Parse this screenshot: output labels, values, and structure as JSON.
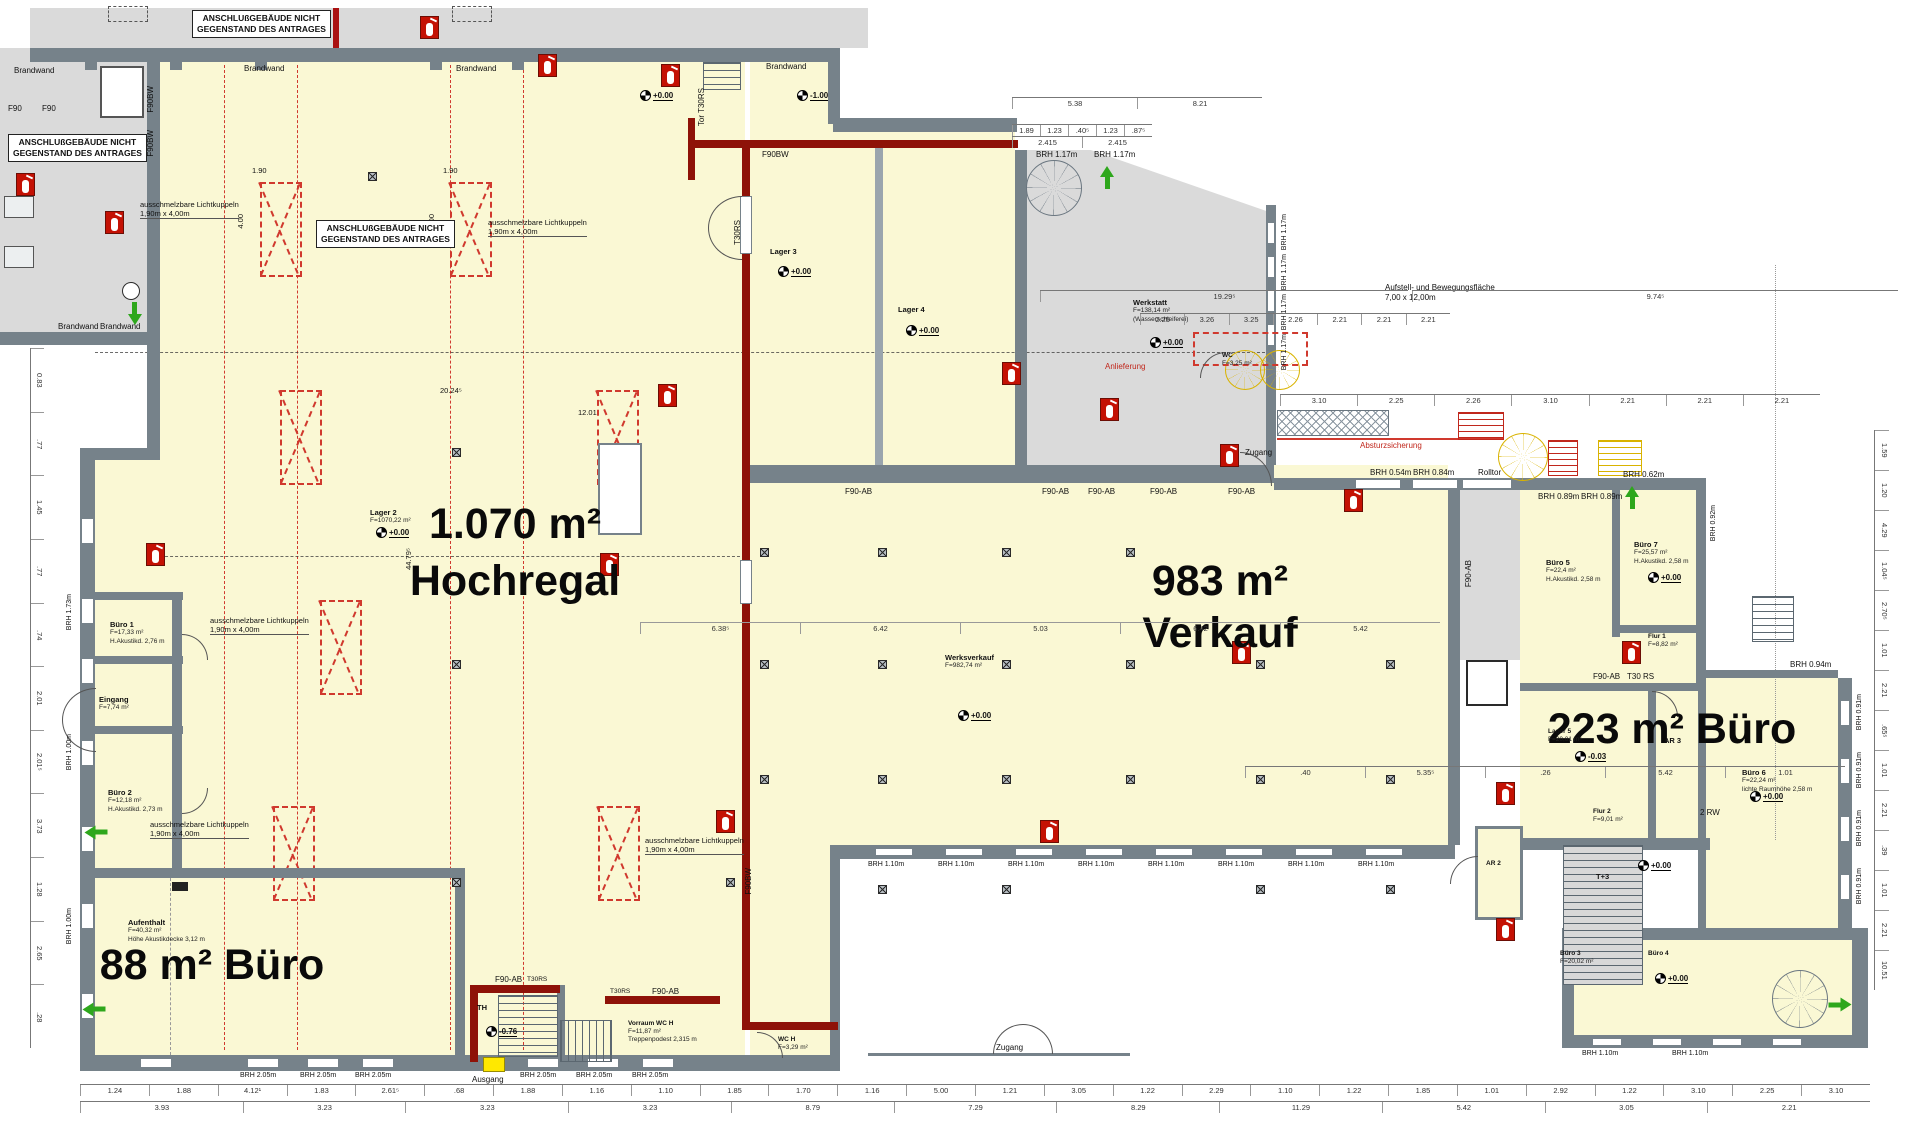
{
  "colors": {
    "floor": "#faf8d4",
    "wall": "#76828a",
    "annex": "#dadada",
    "fire_wall": "#8e1208",
    "dome_red": "#d0392e",
    "escape_green": "#2ea71c",
    "extinguisher_red": "#c41104",
    "highlight_yellow": "#ffe800"
  },
  "icons": {
    "fire_extinguisher": "red square with white extinguisher pictogram",
    "escape_arrow": "green arrow",
    "column": "crossed square",
    "elevation_marker": "quartered circle",
    "light_dome": "red dashed rectangle with X",
    "stairs": "striped run",
    "spiral_stairs": "radial circle",
    "elevator": "crossed white box"
  },
  "titles": {
    "hochregal_size": "1.070 m²",
    "hochregal_name": "Hochregal",
    "verkauf_size": "983 m²",
    "verkauf_name": "Verkauf",
    "buero223": "223 m² Büro",
    "buero88": "88 m² Büro"
  },
  "annex_note": {
    "line1": "ANSCHLUßGEBÄUDE NICHT",
    "line2": "GEGENSTAND DES ANTRAGES"
  },
  "labels": {
    "brandwand": "Brandwand",
    "f90": "F90",
    "f90bw": "F90BW",
    "f90ab": "F90-AB",
    "t30rs": "T30RS",
    "tor_t30rs": "Tor T30RS",
    "t30_rs": "T30 RS",
    "zugang": "Zugang",
    "ausgang": "Ausgang",
    "rolltor": "Rolltor",
    "absturzsicherung": "Absturzsicherung",
    "anlieferung": "Anlieferung",
    "rw2": "2 RW",
    "kuppel1": "ausschmelzbare Lichtkuppeln",
    "kuppel2": "1,90m x 4,00m",
    "aufstell1": "Aufstell- und Bewegungsfläche",
    "aufstell2": "7,00 x 12,00m"
  },
  "win": {
    "brh117": "BRH 1.17m",
    "brh054": "BRH 0.54m",
    "brh084": "BRH 0.84m",
    "brh089": "BRH 0.89m",
    "brh062": "BRH 0.62m",
    "brh092": "BRH 0.92m",
    "brh094": "BRH 0.94m",
    "brh091": "BRH 0.91m",
    "brh205": "BRH 2.05m",
    "brh110": "BRH 1.10m",
    "brh173": "BRH 1.73m",
    "brh100": "BRH 1.00m"
  },
  "markers": {
    "p000": "+0.00",
    "m100": "-1.00"
  },
  "rooms": {
    "lager2": {
      "name": "Lager 2",
      "info": "F=1070,22 m²",
      "elev": "+0.00"
    },
    "lager3": {
      "name": "Lager 3",
      "elev": "+0.00"
    },
    "lager4": {
      "name": "Lager 4",
      "elev": "+0.00"
    },
    "lager5": {
      "name": "Lager 5",
      "info": "F=20,01 m²",
      "elev": "-0.03"
    },
    "werkstatt": {
      "name": "Werkstatt",
      "info": "F=138,14 m²",
      "info2": "(Wasserschleiferei)",
      "elev": "+0.00"
    },
    "werksverkauf": {
      "name": "Werksverkauf",
      "info": "F=982,74 m²",
      "elev": "+0.00"
    },
    "buero1": {
      "name": "Büro 1",
      "info": "F=17,33 m²",
      "info2": "H.Akustikd. 2,76 m"
    },
    "buero2": {
      "name": "Büro 2",
      "info": "F=12,18 m²",
      "info2": "H.Akustikd. 2,73 m"
    },
    "eingang": {
      "name": "Eingang",
      "info": "F=7,74 m²"
    },
    "aufenthalt": {
      "name": "Aufenthalt",
      "info": "F=40,32 m²",
      "info2": "Höhe Akustikdecke 3,12 m"
    },
    "th": {
      "name": "TH",
      "elev": "-0.76"
    },
    "vorraum": {
      "name": "Vorraum WC H",
      "info": "F=11,87 m²",
      "info2": "Treppenpodest 2,315 m"
    },
    "wch": {
      "name": "WC H",
      "info": "F=3,29 m²"
    },
    "wc": {
      "name": "WC",
      "info": "F=3,25 m²"
    },
    "buero5": {
      "name": "Büro 5",
      "info": "F=22,4 m²",
      "info2": "H.Akustikd. 2,58 m"
    },
    "buero7": {
      "name": "Büro 7",
      "info": "F=25,57 m²",
      "info2": "H.Akustikd. 2,58 m",
      "elev": "+0.00"
    },
    "flur1": {
      "name": "Flur 1",
      "info": "F=8,82 m²"
    },
    "flur2": {
      "name": "Flur 2",
      "info": "F=9,01 m²"
    },
    "ar2": {
      "name": "AR 2"
    },
    "ar3": {
      "name": "AR 3"
    },
    "buero6": {
      "name": "Büro 6",
      "info": "F=22,24 m²",
      "info2": "lichte Raumhöhe 2,58 m",
      "elev": "+0.00"
    },
    "t3": {
      "name": "T+3",
      "elev": "+0.00"
    },
    "buero3": {
      "name": "Büro 3",
      "info": "F=20,02 m²"
    },
    "buero4": {
      "name": "Büro 4",
      "elev": "+0.00"
    }
  },
  "dims": {
    "bottom_row1": [
      "1.24",
      "1.88",
      "4.12¹",
      "1.83",
      "2.61⁵",
      ".68",
      "1.88",
      "1.16",
      "1.10",
      "1.85",
      "1.70",
      "1.16",
      "5.00",
      "1.21",
      "3.05",
      "1.22",
      "2.29",
      "1.10",
      "1.22",
      "1.85",
      "1.01",
      "2.92",
      "1.22",
      "3.10",
      "2.25",
      "3.10"
    ],
    "bottom_row2": [
      "3.93",
      "3.23",
      "3.23",
      "3.23",
      "8.79",
      "7.29",
      "8.29",
      "11.29",
      "5.42",
      "3.05",
      "2.21"
    ],
    "right_col": [
      "1.59",
      "1.20",
      "4.29",
      "1.04⁵",
      "2.70⁵",
      "1.01",
      "2.21",
      ".65⁵",
      "1.01",
      "2.21",
      ".39",
      "1.01",
      "2.21",
      "10.51"
    ],
    "left_col": [
      "0.83",
      ".77",
      "1.45",
      ".77",
      ".74",
      "2.01",
      "2.01⁵",
      "3.73",
      "1.28",
      "2.65",
      ".28"
    ],
    "top_row0": [
      "5.38",
      "8.21"
    ],
    "top_row1": [
      "1.89",
      "1.23",
      ".40⁵",
      "1.23",
      ".87⁵"
    ],
    "top_row2": [
      "2.415",
      "2.415"
    ],
    "upper_white": [
      "3.10",
      "2.25",
      "2.26",
      "3.10",
      "2.21",
      "2.21",
      "2.21"
    ],
    "mid_row": [
      "2.25",
      "3.26",
      "3.25",
      "2.26",
      "2.21",
      "2.21",
      "2.21"
    ],
    "verkauf_row": [
      "6.38⁵",
      "6.42",
      "5.03",
      "6.42",
      "5.42"
    ],
    "br_row": [
      ".40",
      "5.35⁵",
      ".26",
      "5.42",
      "1.01"
    ],
    "long_a": [
      "19.29⁵"
    ],
    "long_b": [
      "9.74⁵"
    ],
    "d190": "1.90",
    "d400": "4.00",
    "d2024": "20.24⁵",
    "d1201": "12.01",
    "d4479": "44.79⁵"
  }
}
